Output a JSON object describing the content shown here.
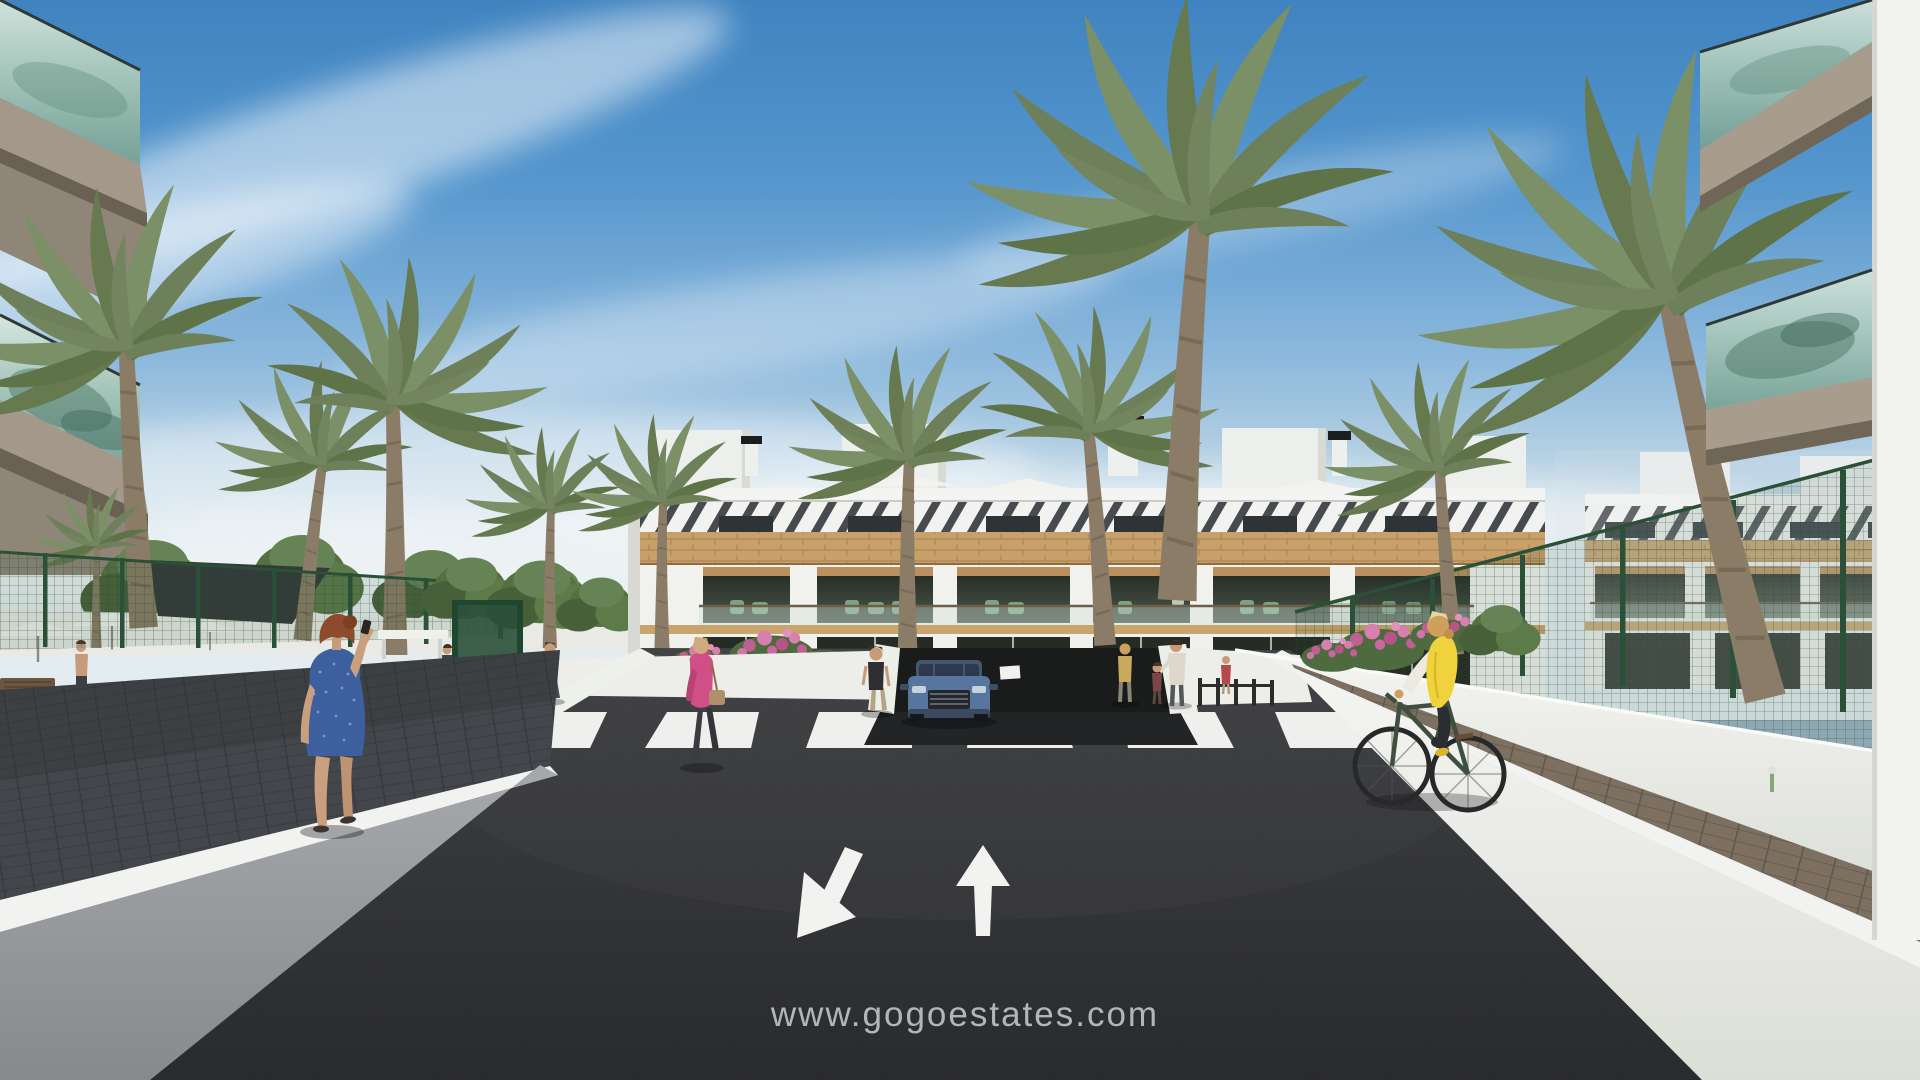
{
  "watermark": {
    "text": "www.gogoestates.com"
  },
  "road_markings": {
    "crosswalk_stripe_count": 6,
    "large_arrows": [
      "down-left",
      "up"
    ],
    "small_arrows": [
      "down",
      "up"
    ]
  },
  "entities": {
    "buildings": [
      "left-foreground-balcony-building",
      "central-apartment-block",
      "right-background-apartment-block",
      "right-foreground-balcony-building"
    ],
    "vehicles": [
      "blue-suv-exiting-garage"
    ],
    "people": [
      "woman-blue-dress-on-phone",
      "woman-pink-jacket-with-bag",
      "woman-standing-near-crosswalk",
      "man-white-tshirt-at-gate",
      "man-at-pool-area",
      "pedestrian-group-near-building",
      "child-near-building",
      "distant-walker",
      "figure-on-balcony",
      "cyclist-yellow-vest"
    ],
    "vegetation": [
      "palm-trees",
      "round-trees",
      "hedges",
      "pink-flower-beds"
    ],
    "street_furniture": [
      "green-mesh-fence",
      "pedestrian-gate",
      "shade-sail",
      "parasols",
      "bench",
      "bike-racks",
      "garden-sprinkler"
    ]
  },
  "colors": {
    "sky_top": "#3f83c0",
    "sky_horizon": "#e3ecf0",
    "asphalt": "#2c2d2f",
    "sunlit_wall": "#f0f1ed",
    "shaded_wall": "#9a9da0",
    "curb_stripe": "#f2f3f1",
    "facade_white": "#f2f3f0",
    "stone_band": "#c7a06a",
    "balcony_glass": "#a9c8ba",
    "palm_green": "#76895e",
    "fence_green": "#2a5038",
    "suv_blue": "#56759f",
    "vest_yellow": "#f0d33c",
    "dress_blue": "#3d5f9e",
    "jacket_pink": "#cf4f86"
  }
}
